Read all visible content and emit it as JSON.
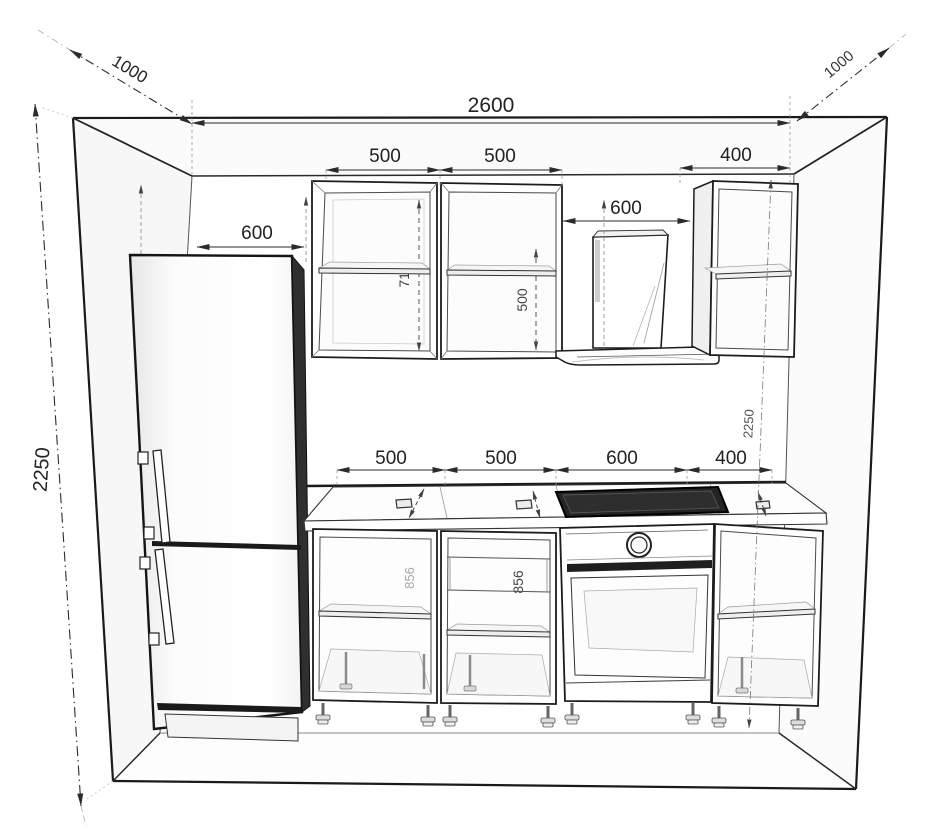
{
  "meta": {
    "drawing_type": "kitchen elevation technical drawing",
    "units": "mm"
  },
  "room": {
    "width_mm": "2600",
    "depth_left_mm": "1000",
    "depth_right_mm": "1000",
    "height_left_mm": "2250",
    "height_right_mm": "2250"
  },
  "fridge": {
    "width_mm": "600"
  },
  "wall_cabinets": {
    "cab1_width_mm": "500",
    "cab2_width_mm": "500",
    "hood_width_mm": "600",
    "cab3_width_mm": "400",
    "cab1_height_mm": "710",
    "cab2_door_height_mm": "500"
  },
  "base_cabinets": {
    "cab1_width_mm": "500",
    "cab2_width_mm": "500",
    "oven_width_mm": "600",
    "cab3_width_mm": "400",
    "cab1_carcass_height_mm": "856",
    "cab2_carcass_height_mm": "856",
    "oven_carcass_height_mm": "856"
  },
  "colors": {
    "ink": "#1c1c1c",
    "dimension": "#2b2b2b",
    "faint_line": "#999999",
    "dark_fill": "#1a1a1a",
    "side_shade": "#2f2f2f",
    "paper": "#ffffff"
  }
}
